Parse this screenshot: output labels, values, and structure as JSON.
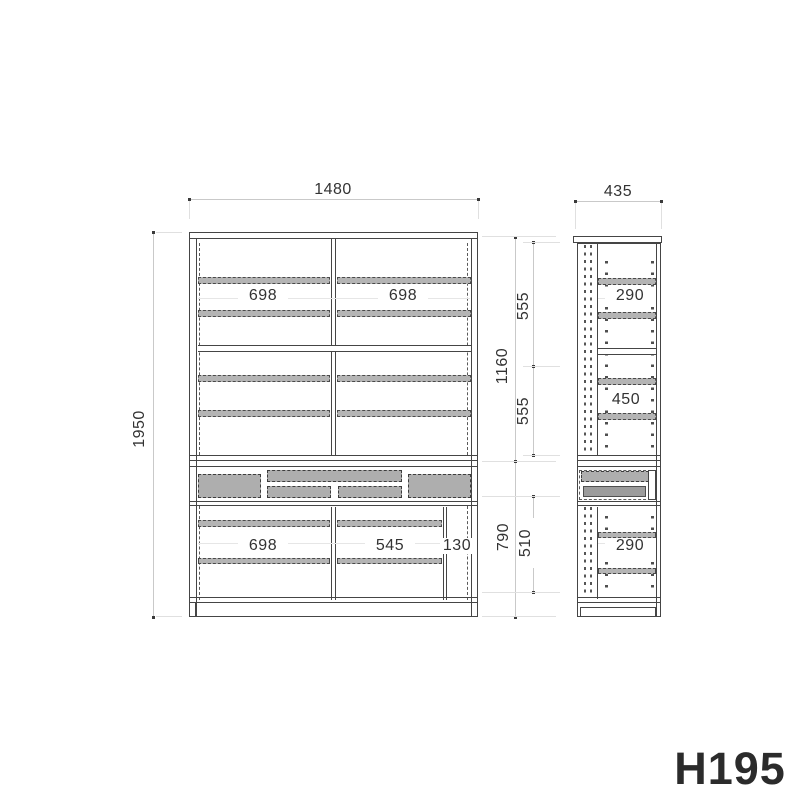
{
  "title": "H195",
  "front_view": {
    "width": "1480",
    "height": "1950",
    "upper_height": "1160",
    "lower_height": "790",
    "upper_inner": [
      "555",
      "555"
    ],
    "lower_inner": "510",
    "upper_widths": [
      "698",
      "698"
    ],
    "lower_widths": [
      "698",
      "545",
      "130"
    ]
  },
  "side_view": {
    "depth": "435",
    "shelf_depths": [
      "290",
      "450",
      "290"
    ]
  }
}
